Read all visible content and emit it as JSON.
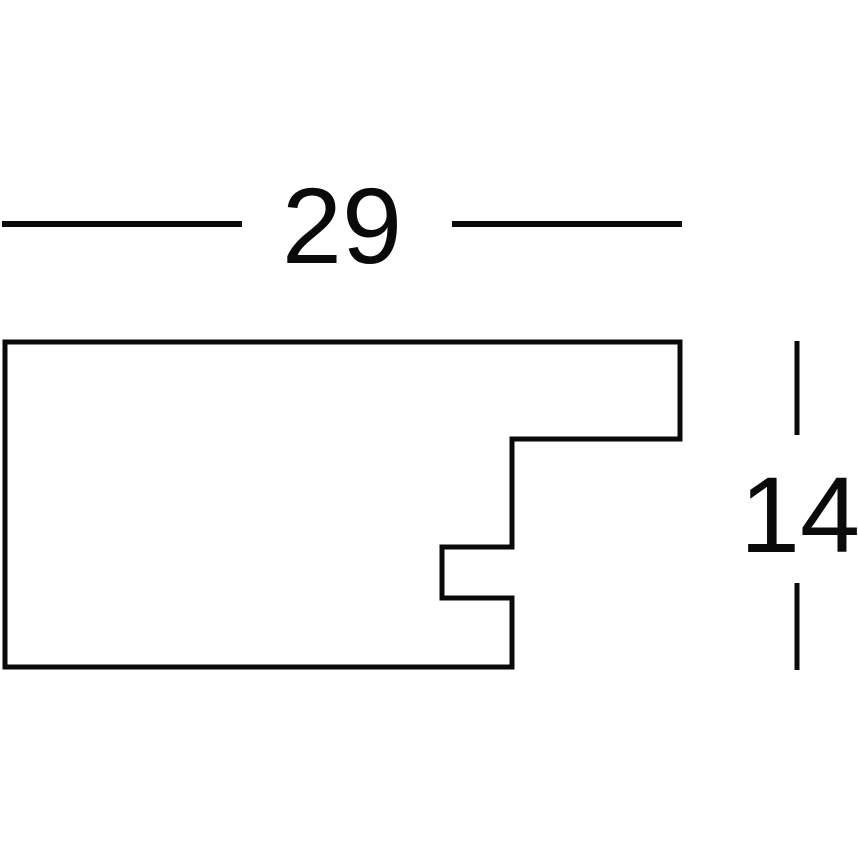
{
  "drawing": {
    "description": "Technical cross-section profile drawing of a frame moulding with two dimension callouts",
    "background_color": "#ffffff",
    "line_color": "#0a0a0a",
    "profile": {
      "path": "M 5 342 L 680 342 L 680 439 L 512 439 L 512 547 L 442 547 L 442 598 L 512 598 L 512 667 L 5 667 Z",
      "stroke_width": 5
    },
    "width_dimension": {
      "label": "29",
      "label_x": 342,
      "label_baseline_y": 263,
      "line_left": {
        "x1": 2,
        "y1": 224,
        "x2": 242,
        "y2": 224
      },
      "line_right": {
        "x1": 452,
        "y1": 224,
        "x2": 682,
        "y2": 224
      },
      "stroke_width": 6
    },
    "height_dimension": {
      "label": "14",
      "label_x": 800,
      "label_baseline_y": 552,
      "line_upper": {
        "x1": 797,
        "y1": 341,
        "x2": 797,
        "y2": 435
      },
      "line_lower": {
        "x1": 797,
        "y1": 583,
        "x2": 797,
        "y2": 670
      },
      "stroke_width": 5
    }
  }
}
